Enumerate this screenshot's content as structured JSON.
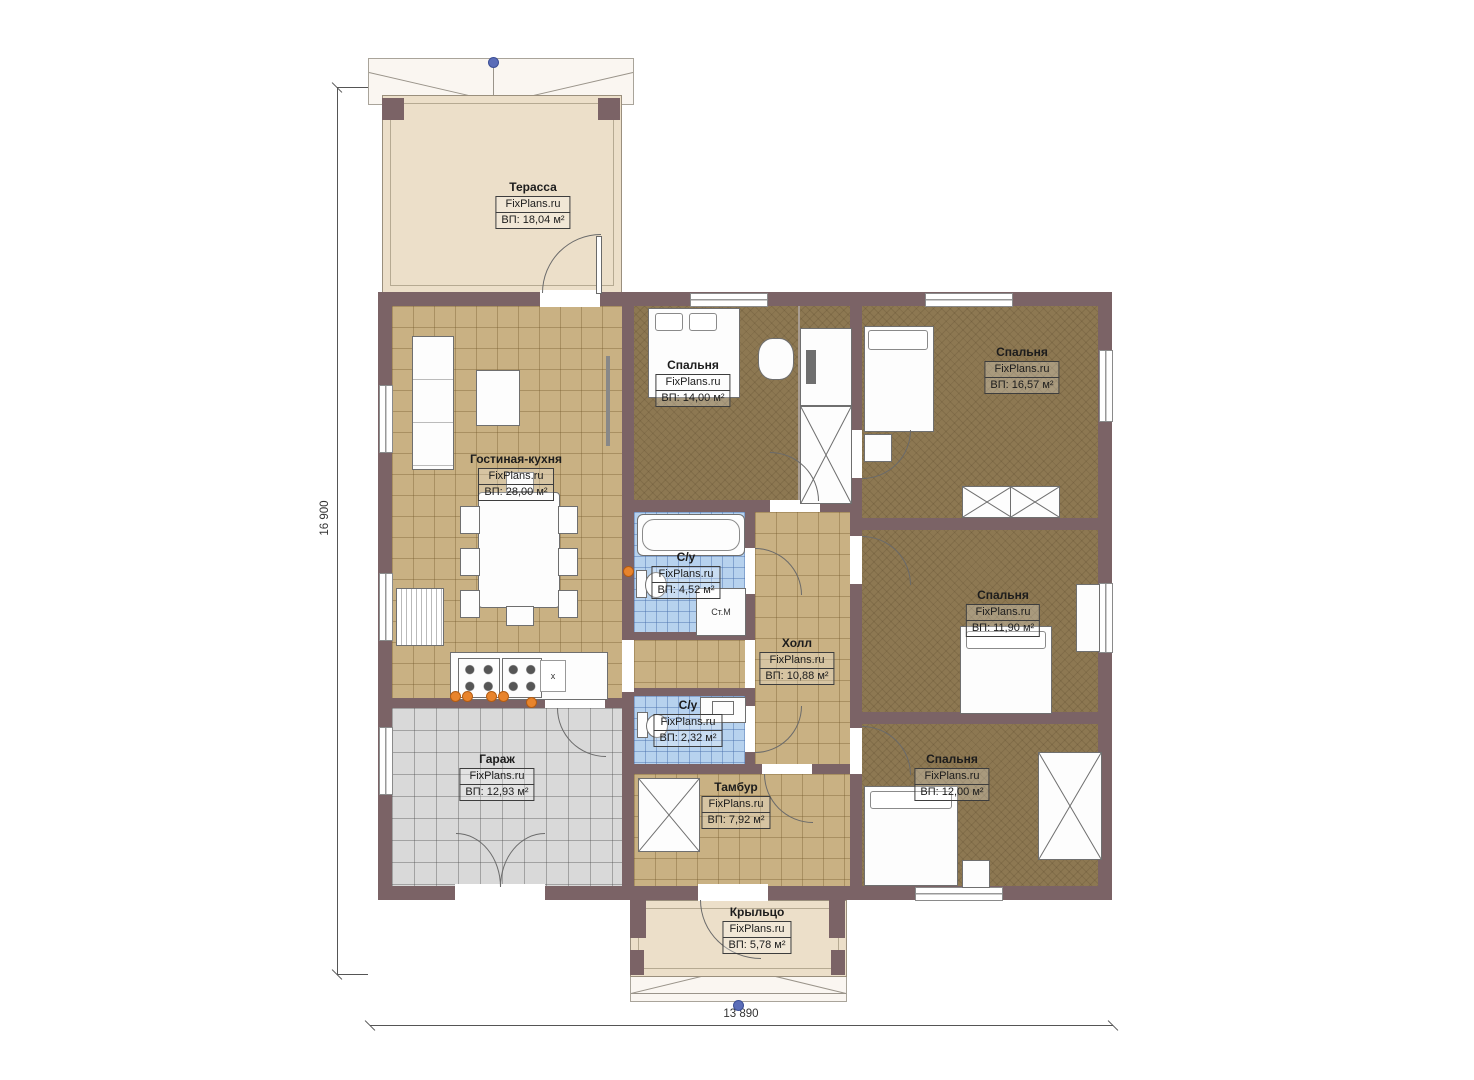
{
  "rooms": [
    {
      "id": "terrace",
      "name": "Терасса",
      "brand": "FixPlans.ru",
      "area": "ВП: 18,04 м²"
    },
    {
      "id": "bedroom-1",
      "name": "Спальня",
      "brand": "FixPlans.ru",
      "area": "ВП: 14,00 м²"
    },
    {
      "id": "bedroom-2",
      "name": "Спальня",
      "brand": "FixPlans.ru",
      "area": "ВП: 16,57 м²"
    },
    {
      "id": "living-kitchen",
      "name": "Гостиная-кухня",
      "brand": "FixPlans.ru",
      "area": "ВП: 28,00 м²"
    },
    {
      "id": "bathroom-1",
      "name": "С/у",
      "brand": "FixPlans.ru",
      "area": "ВП: 4,52 м²"
    },
    {
      "id": "hall",
      "name": "Холл",
      "brand": "FixPlans.ru",
      "area": "ВП: 10,88 м²"
    },
    {
      "id": "bedroom-3",
      "name": "Спальня",
      "brand": "FixPlans.ru",
      "area": "ВП: 11,90 м²"
    },
    {
      "id": "bathroom-2",
      "name": "С/у",
      "brand": "FixPlans.ru",
      "area": "ВП: 2,32 м²"
    },
    {
      "id": "garage",
      "name": "Гараж",
      "brand": "FixPlans.ru",
      "area": "ВП: 12,93 м²"
    },
    {
      "id": "tambur",
      "name": "Тамбур",
      "brand": "FixPlans.ru",
      "area": "ВП: 7,92 м²"
    },
    {
      "id": "bedroom-4",
      "name": "Спальня",
      "brand": "FixPlans.ru",
      "area": "ВП: 12,00 м²"
    },
    {
      "id": "porch",
      "name": "Крыльцо",
      "brand": "FixPlans.ru",
      "area": "ВП: 5,78 м²"
    }
  ],
  "dimensions": {
    "vertical": "16 900",
    "horizontal": "13 890"
  },
  "annotations": {
    "washing_machine": "Ст.М",
    "sink_marker": "х"
  },
  "colors": {
    "wall": "#7b6366",
    "living_floor": "#c9b183",
    "bedroom_floor": "#8d7852",
    "bath_floor": "#b7d2ee",
    "garage_floor": "#d9d9d9",
    "terrace_floor": "#ecdfc9",
    "accent_dot": "#e8842c",
    "grip_handle": "#5b6db8"
  }
}
